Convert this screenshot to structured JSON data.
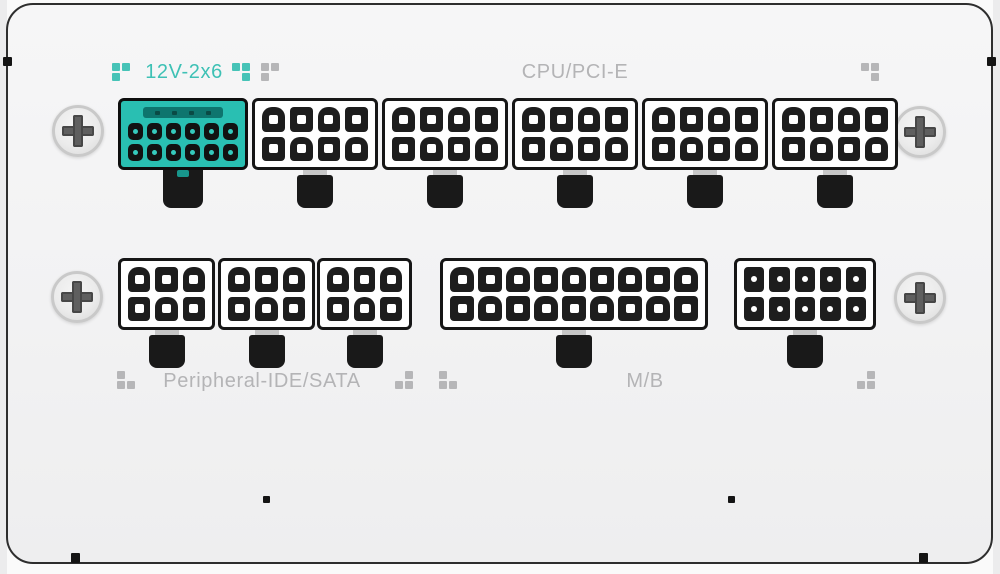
{
  "labels": {
    "twelve_v": "12V-2x6",
    "cpu_pcie": "CPU/PCI-E",
    "peripheral": "Peripheral-IDE/SATA",
    "mb": "M/B"
  },
  "colors": {
    "accent_teal": "#29bfb2",
    "label_gray": "#b4b4b6",
    "connector_black": "#1a1a1a",
    "case_face": "#f3f3f4"
  },
  "connectors": {
    "top_row": [
      {
        "id": "socket-12v-2x6",
        "label": "12V-2x6",
        "rows": 2,
        "cols": 6,
        "style": "teal",
        "pin_shape": "square",
        "sense_pins": 4
      },
      {
        "id": "socket-cpu-pcie-1",
        "label": "CPU/PCI-E 8-pin",
        "rows": 2,
        "cols": 4,
        "style": "white",
        "pin_shape": "mixed"
      },
      {
        "id": "socket-cpu-pcie-2",
        "label": "CPU/PCI-E 8-pin",
        "rows": 2,
        "cols": 4,
        "style": "white",
        "pin_shape": "mixed"
      },
      {
        "id": "socket-cpu-pcie-3",
        "label": "CPU/PCI-E 8-pin",
        "rows": 2,
        "cols": 4,
        "style": "white",
        "pin_shape": "mixed"
      },
      {
        "id": "socket-cpu-pcie-4",
        "label": "CPU/PCI-E 8-pin",
        "rows": 2,
        "cols": 4,
        "style": "white",
        "pin_shape": "mixed"
      },
      {
        "id": "socket-cpu-pcie-5",
        "label": "CPU/PCI-E 8-pin",
        "rows": 2,
        "cols": 4,
        "style": "white",
        "pin_shape": "mixed"
      }
    ],
    "bottom_row": [
      {
        "id": "socket-peripheral-1",
        "label": "Peripheral-IDE/SATA 6-pin",
        "rows": 2,
        "cols": 3,
        "style": "white",
        "pin_shape": "mixed"
      },
      {
        "id": "socket-peripheral-2",
        "label": "Peripheral-IDE/SATA 6-pin",
        "rows": 2,
        "cols": 3,
        "style": "white",
        "pin_shape": "mixed"
      },
      {
        "id": "socket-peripheral-3",
        "label": "Peripheral-IDE/SATA 6-pin",
        "rows": 2,
        "cols": 3,
        "style": "white",
        "pin_shape": "mixed"
      },
      {
        "id": "socket-mb-18pin",
        "label": "M/B 18-pin",
        "rows": 2,
        "cols": 9,
        "style": "white mb",
        "pin_shape": "mixed"
      },
      {
        "id": "socket-mb-10pin",
        "label": "M/B 10-pin",
        "rows": 2,
        "cols": 5,
        "style": "white dot-hole",
        "pin_shape": "square"
      }
    ]
  },
  "decor": [
    {
      "id": "dots-1",
      "color": "teal",
      "pattern": [
        [
          1,
          1
        ],
        [
          1,
          0
        ]
      ]
    },
    {
      "id": "dots-2",
      "color": "teal",
      "pattern": [
        [
          1,
          1
        ],
        [
          0,
          1
        ]
      ]
    },
    {
      "id": "dots-3",
      "color": "gray",
      "pattern": [
        [
          1,
          1
        ],
        [
          1,
          0
        ]
      ]
    },
    {
      "id": "dots-4",
      "color": "gray",
      "pattern": [
        [
          1,
          1
        ],
        [
          0,
          1
        ]
      ]
    },
    {
      "id": "dots-5",
      "color": "gray",
      "pattern": [
        [
          1,
          0
        ],
        [
          1,
          1
        ]
      ]
    },
    {
      "id": "dots-6",
      "color": "gray",
      "pattern": [
        [
          0,
          1
        ],
        [
          1,
          1
        ]
      ]
    },
    {
      "id": "dots-7",
      "color": "gray",
      "pattern": [
        [
          1,
          0
        ],
        [
          1,
          1
        ]
      ]
    },
    {
      "id": "dots-8",
      "color": "gray",
      "pattern": [
        [
          0,
          1
        ],
        [
          1,
          1
        ]
      ]
    }
  ]
}
